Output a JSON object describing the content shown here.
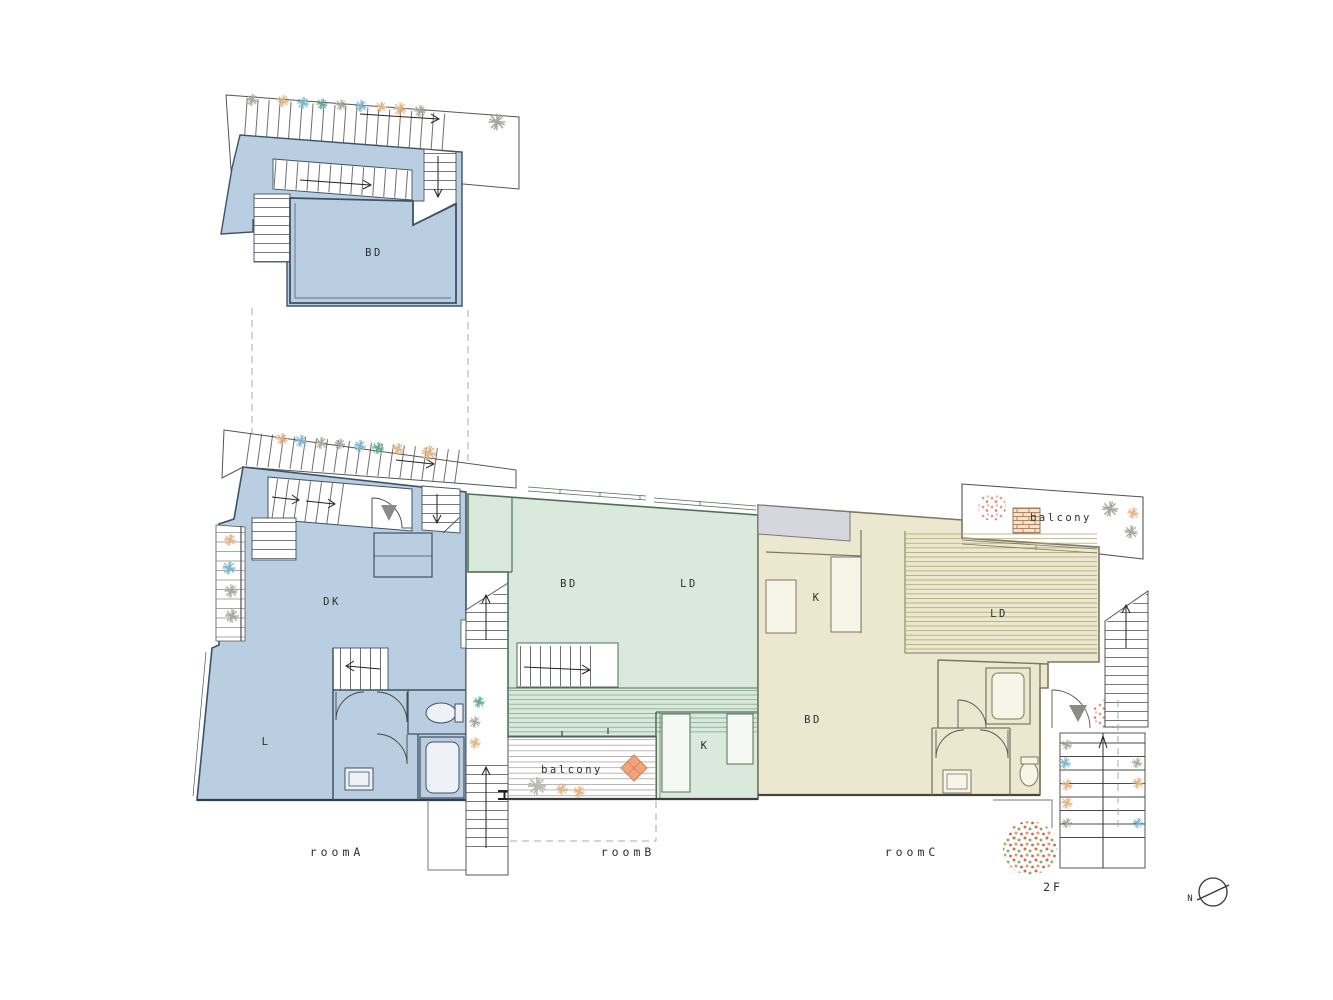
{
  "title": "2F floor plan",
  "floor": {
    "label": "2F"
  },
  "compass": {
    "north_label": "N"
  },
  "units": {
    "roomA": {
      "label": "roomA",
      "fill": "#b9cee1",
      "wall_color": "#3f5166",
      "rooms": {
        "loft_bd": "BD",
        "dk": "DK",
        "living": "L"
      }
    },
    "roomB": {
      "label": "roomB",
      "fill": "#d9e9dc",
      "wall_color": "#4f6f58",
      "rooms": {
        "bd": "BD",
        "ld": "LD",
        "kitchen": "K",
        "balcony": "balcony"
      }
    },
    "roomC": {
      "label": "roomC",
      "fill": "#ece8cf",
      "wall_color": "#7d7860",
      "rooms": {
        "kitchen": "K",
        "ld": "LD",
        "bd": "BD",
        "balcony": "balcony"
      }
    }
  }
}
